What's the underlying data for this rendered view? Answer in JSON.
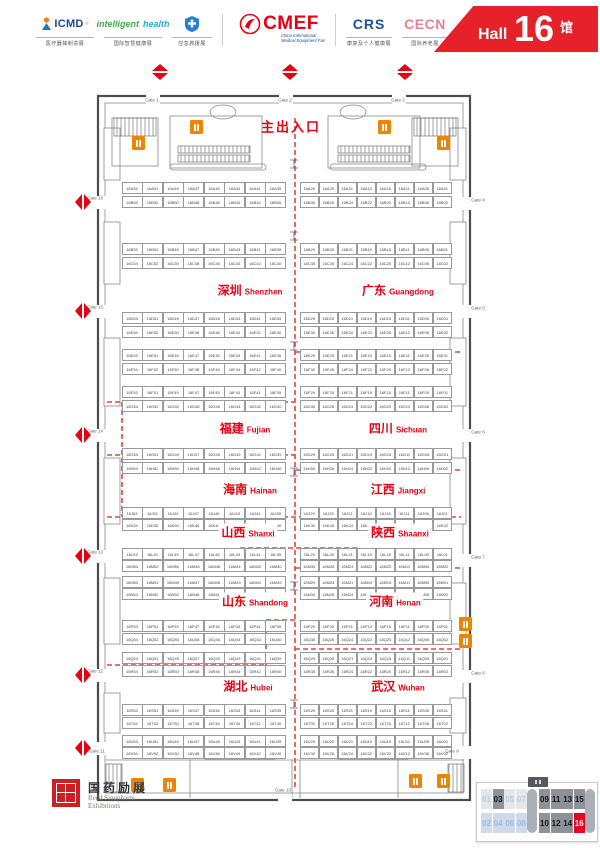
{
  "header": {
    "logos": [
      {
        "id": "icmd",
        "text": "ICMD",
        "reg": "®",
        "caption": "医疗器械制造展"
      },
      {
        "id": "intelligent-health",
        "text1": "intelligent",
        "text2": "health",
        "caption": "国际智慧健康展"
      },
      {
        "id": "emergency-rescue",
        "caption": "应急救援展"
      },
      {
        "id": "cmef",
        "text": "CMEF",
        "sub1": "China International",
        "sub2": "Medical Equipment Fair"
      },
      {
        "id": "crs",
        "text": "CRS",
        "caption": "康复及个人健康展"
      },
      {
        "id": "cecn",
        "text": "CECN",
        "caption": "国际养老展"
      },
      {
        "id": "home-healthcare",
        "caption": "家用医疗展"
      }
    ],
    "hall": {
      "word": "Hall",
      "number": "16",
      "cn": "馆"
    }
  },
  "plan": {
    "main_entrance": "主出入口",
    "gates": [
      {
        "label": "Gate 1",
        "x": 152,
        "y": 100
      },
      {
        "label": "Gate 2",
        "x": 285,
        "y": 100
      },
      {
        "label": "Gate 3",
        "x": 398,
        "y": 100
      },
      {
        "label": "Gate 4",
        "x": 478,
        "y": 200
      },
      {
        "label": "Gate 5",
        "x": 478,
        "y": 308
      },
      {
        "label": "Gate 6",
        "x": 478,
        "y": 432
      },
      {
        "label": "Gate 7",
        "x": 478,
        "y": 557
      },
      {
        "label": "Gate 8",
        "x": 478,
        "y": 673
      },
      {
        "label": "Gate 9",
        "x": 452,
        "y": 751
      },
      {
        "label": "Gate 10",
        "x": 283,
        "y": 790
      },
      {
        "label": "Gate 11",
        "x": 97,
        "y": 751
      },
      {
        "label": "Gate 12",
        "x": 95,
        "y": 671
      },
      {
        "label": "Gate 13",
        "x": 95,
        "y": 552
      },
      {
        "label": "Gate 14",
        "x": 95,
        "y": 431
      },
      {
        "label": "Gate 15",
        "x": 95,
        "y": 307
      },
      {
        "label": "Gate 16",
        "x": 95,
        "y": 198
      }
    ],
    "diamonds": [
      {
        "x": 160,
        "y": 72,
        "dir": "v"
      },
      {
        "x": 290,
        "y": 72,
        "dir": "v"
      },
      {
        "x": 405,
        "y": 72,
        "dir": "v"
      },
      {
        "x": 83,
        "y": 202,
        "dir": "h"
      },
      {
        "x": 83,
        "y": 311,
        "dir": "h"
      },
      {
        "x": 83,
        "y": 435,
        "dir": "h"
      },
      {
        "x": 83,
        "y": 556,
        "dir": "h"
      },
      {
        "x": 83,
        "y": 675,
        "dir": "h"
      },
      {
        "x": 83,
        "y": 748,
        "dir": "h"
      }
    ],
    "regions": [
      {
        "cn": "深圳",
        "en": "Shenzhen",
        "cx": 250,
        "y": 290
      },
      {
        "cn": "广东",
        "en": "Guangdong",
        "cx": 398,
        "y": 290
      },
      {
        "cn": "福建",
        "en": "Fujian",
        "cx": 245,
        "y": 428
      },
      {
        "cn": "四川",
        "en": "Sichuan",
        "cx": 398,
        "y": 428
      },
      {
        "cn": "海南",
        "en": "Hainan",
        "cx": 250,
        "y": 489
      },
      {
        "cn": "江西",
        "en": "Jiangxi",
        "cx": 398,
        "y": 489
      },
      {
        "cn": "山西",
        "en": "Shanxi",
        "cx": 248,
        "y": 532
      },
      {
        "cn": "陕西",
        "en": "Shaanxi",
        "cx": 400,
        "y": 532
      },
      {
        "cn": "山东",
        "en": "Shandong",
        "cx": 255,
        "y": 601
      },
      {
        "cn": "河南",
        "en": "Henan",
        "cx": 395,
        "y": 601
      },
      {
        "cn": "湖北",
        "en": "Hubei",
        "cx": 248,
        "y": 686
      },
      {
        "cn": "武汉",
        "en": "Wuhan",
        "cx": 398,
        "y": 686
      }
    ],
    "toilets": [
      {
        "x": 190,
        "y": 120
      },
      {
        "x": 378,
        "y": 120
      },
      {
        "x": 132,
        "y": 136
      },
      {
        "x": 437,
        "y": 136
      },
      {
        "x": 459,
        "y": 617
      },
      {
        "x": 459,
        "y": 634
      },
      {
        "x": 131,
        "y": 778
      },
      {
        "x": 163,
        "y": 778
      },
      {
        "x": 409,
        "y": 774
      },
      {
        "x": 437,
        "y": 774
      }
    ],
    "booth_rows": [
      {
        "y": 182,
        "left": [
          "16A53",
          "16A51",
          "16A49",
          "16A47",
          "16A45",
          "16A43",
          "16A41",
          "16A39"
        ],
        "right": [
          "16A29",
          "16A25",
          "16A21",
          "16A19",
          "16A15",
          "16A11",
          "16A05",
          "16A01"
        ]
      },
      {
        "y": 196,
        "left": [
          "16B54",
          "16B52",
          "16B50",
          "16B48",
          "16B46",
          "16B44",
          "16B42",
          "16B40"
        ],
        "right": [
          "16B30",
          "16B26",
          "16B24",
          "16B22",
          "16B20",
          "16B12",
          "16B06",
          "16B02"
        ]
      },
      {
        "y": 243,
        "left": [
          "16B53",
          "16B51",
          "16B49",
          "16B47",
          "16B45",
          "16B43",
          "16B41",
          "16B39"
        ],
        "right": [
          "16B29",
          "16B25",
          "16B21",
          "16B19",
          "16B15",
          "16B11",
          "16B05",
          "16B01"
        ]
      },
      {
        "y": 257,
        "left": [
          "16C54",
          "16C52",
          "16C50",
          "16C48",
          "16C46",
          "16C44",
          "16C42",
          "16C40"
        ],
        "right": [
          "16C30",
          "16C26",
          "16C24",
          "16C22",
          "16C20",
          "16C12",
          "16C06",
          "16C02"
        ]
      },
      {
        "y": 312,
        "left": [
          "16D53",
          "16D51",
          "16D49",
          "16D47",
          "16D45",
          "16D43",
          "16D41",
          "16D39"
        ],
        "right": [
          "16D29",
          "16D25",
          "16D21",
          "16D19",
          "16D15",
          "16D11",
          "16D05",
          "16D01"
        ]
      },
      {
        "y": 326,
        "left": [
          "16E54",
          "16E52",
          "16E50",
          "16E48",
          "16E46",
          "16E44",
          "16E42",
          "16E40"
        ],
        "right": [
          "16E30",
          "16E26",
          "16E24",
          "16E22",
          "16E20",
          "16E12",
          "16E06",
          "16E02"
        ]
      },
      {
        "y": 349,
        "left": [
          "16E53",
          "16E51",
          "16E49",
          "16E47",
          "16E45",
          "16E43",
          "16E41",
          "16E39"
        ],
        "right": [
          "16E29",
          "16E25",
          "16E21",
          "16E19",
          "16E15",
          "16E11",
          "16E05",
          "16E01"
        ]
      },
      {
        "y": 363,
        "left": [
          "16F54",
          "16F52",
          "16F50",
          "16F48",
          "16F46",
          "16F44",
          "16F42",
          "16F40"
        ],
        "right": [
          "16F30",
          "16F26",
          "16F24",
          "16F22",
          "16F20",
          "16F12",
          "16F06",
          "16F02"
        ]
      },
      {
        "y": 386,
        "left": [
          "16F53",
          "16F51",
          "16F49",
          "16F47",
          "16F45",
          "16F43",
          "16F41",
          "16F39"
        ],
        "right": [
          "16F29",
          "16F25",
          "16F21",
          "16F19",
          "16F15",
          "16F11",
          "16F05",
          "16F01"
        ]
      },
      {
        "y": 400,
        "left": [
          "16G54",
          "16G52",
          "16G50",
          "16G48",
          "16G46",
          "16G44",
          "16G42",
          "16G40"
        ],
        "right": [
          "16G30",
          "16G26",
          "16G24",
          "16G22",
          "16G20",
          "16G12",
          "16G06",
          "16G02"
        ]
      },
      {
        "y": 448,
        "left": [
          "16G53",
          "16G51",
          "16G49",
          "16G47",
          "16G45",
          "16G43",
          "16G41",
          "16G39"
        ],
        "right": [
          "16G29",
          "16G25",
          "16G21",
          "16G19",
          "16G15",
          "16G11",
          "16G05",
          "16G01"
        ]
      },
      {
        "y": 462,
        "left": [
          "16H54",
          "16H52",
          "16H50",
          "16H48",
          "16H46",
          "16H44",
          "16H42",
          "16H40"
        ],
        "right": [
          "16H30",
          "16H26",
          "16H24",
          "16H22",
          "16H20",
          "16H12",
          "16H06",
          "16H02"
        ]
      },
      {
        "y": 507,
        "left": [
          "16J53",
          "16J51",
          "16J49",
          "16J47",
          "16J45",
          "16J43",
          "16J41",
          "16J39"
        ],
        "right": [
          "16J29",
          "16J25",
          "16J21",
          "16J19",
          "16J15",
          "16J11",
          "16J05",
          "16J01"
        ]
      },
      {
        "y": 519,
        "left": [
          "16K54",
          "16K52",
          "16K50",
          "16K48",
          "16K46",
          "16K44",
          "16K42",
          "16K40"
        ],
        "right": [
          "16K30",
          "16K26",
          "16K24",
          "16K22",
          "16K20",
          "16K12",
          "16K06",
          "16K02"
        ]
      },
      {
        "y": 548,
        "left": [
          "16L53",
          "16L51",
          "16L49",
          "16L47",
          "16L45",
          "16L43",
          "16L41",
          "16L39"
        ],
        "right": [
          "16L29",
          "16L25",
          "16L21",
          "16L19",
          "16L15",
          "16L11",
          "16L05",
          "16L01"
        ]
      },
      {
        "y": 560,
        "left": [
          "16M54",
          "16M52",
          "16M50",
          "16M48",
          "16M46",
          "16M44",
          "16M42",
          "16M40"
        ],
        "right": [
          "16M30",
          "16M26",
          "16M24",
          "16M22",
          "16M20",
          "16M12",
          "16M06",
          "16M02"
        ]
      },
      {
        "y": 576,
        "left": [
          "16M53",
          "16M51",
          "16M49",
          "16M47",
          "16M45",
          "16M43",
          "16M41",
          "16M39"
        ],
        "right": [
          "16M29",
          "16M25",
          "16M21",
          "16M19",
          "16M15",
          "16M11",
          "16M05",
          "16M01"
        ]
      },
      {
        "y": 588,
        "left": [
          "16N54",
          "16N52",
          "16N50",
          "16N48",
          "16N46",
          "16N44",
          "16N42",
          "16N40"
        ],
        "right": [
          "16N30",
          "16N26",
          "16N24",
          "16N22",
          "16N20",
          "16N12",
          "16N06",
          "16N02"
        ]
      },
      {
        "y": 620,
        "left": [
          "16P53",
          "16P51",
          "16P49",
          "16P47",
          "16P45",
          "16P43",
          "16P41",
          "16P39"
        ],
        "right": [
          "16P29",
          "16P25",
          "16P21",
          "16P19",
          "16P15",
          "16P11",
          "16P05",
          "16P01"
        ]
      },
      {
        "y": 633,
        "left": [
          "16Q54",
          "16Q52",
          "16Q50",
          "16Q48",
          "16Q46",
          "16Q44",
          "16Q42",
          "16Q40"
        ],
        "right": [
          "16Q30",
          "16Q26",
          "16Q24",
          "16Q22",
          "16Q20",
          "16Q12",
          "16Q06",
          "16Q02"
        ]
      },
      {
        "y": 652,
        "left": [
          "16Q53",
          "16Q51",
          "16Q49",
          "16Q47",
          "16Q45",
          "16Q43",
          "16Q41",
          "16Q39"
        ],
        "right": [
          "16Q29",
          "16Q25",
          "16Q21",
          "16Q19",
          "16Q15",
          "16Q11",
          "16Q05",
          "16Q01"
        ]
      },
      {
        "y": 665,
        "left": [
          "16R54",
          "16R52",
          "16R50",
          "16R48",
          "16R46",
          "16R44",
          "16R42",
          "16R40"
        ],
        "right": [
          "16R30",
          "16R26",
          "16R24",
          "16R22",
          "16R20",
          "16R12",
          "16R06",
          "16R02"
        ]
      },
      {
        "y": 704,
        "left": [
          "16S53",
          "16S51",
          "16S49",
          "16S47",
          "16S45",
          "16S43",
          "16S41",
          "16S39"
        ],
        "right": [
          "16S29",
          "16S25",
          "16S21",
          "16S19",
          "16S15",
          "16S11",
          "16S05",
          "16S01"
        ]
      },
      {
        "y": 717,
        "left": [
          "16T54",
          "16T52",
          "16T50",
          "16T48",
          "16T46",
          "16T44",
          "16T42",
          "16T40"
        ],
        "right": [
          "16T30",
          "16T26",
          "16T24",
          "16T22",
          "16T20",
          "16T12",
          "16T06",
          "16T02"
        ]
      },
      {
        "y": 735,
        "left": [
          "16U53",
          "16U51",
          "16U49",
          "16U47",
          "16U45",
          "16U43",
          "16U41",
          "16U39"
        ],
        "right": [
          "16U29",
          "16U25",
          "16U21",
          "16U19",
          "16U15",
          "16U11",
          "16U05",
          "16U01"
        ]
      },
      {
        "y": 747,
        "left": [
          "16V54",
          "16V52",
          "16V50",
          "16V48",
          "16V46",
          "16V44",
          "16V42",
          "16V40"
        ],
        "right": [
          "16V30",
          "16V26",
          "16V24",
          "16V22",
          "16V20",
          "16V12",
          "16V06",
          "16V02"
        ]
      }
    ]
  },
  "footer": {
    "logo_cn": "国药励展",
    "logo_en1": "Reed Sinopharm",
    "logo_en2": "Exhibitions"
  },
  "legend": {
    "row1": [
      {
        "t": "01",
        "s": "light"
      },
      {
        "t": "03",
        "s": "dark"
      },
      {
        "t": "05",
        "s": "light"
      },
      {
        "t": "07",
        "s": "light"
      },
      {
        "t": "09",
        "s": "dark"
      },
      {
        "t": "11",
        "s": "dark"
      },
      {
        "t": "13",
        "s": "dark"
      },
      {
        "t": "15",
        "s": "dark"
      }
    ],
    "row2": [
      {
        "t": "02",
        "s": "blue"
      },
      {
        "t": "04",
        "s": "blue"
      },
      {
        "t": "06",
        "s": "blue"
      },
      {
        "t": "08",
        "s": "blue"
      },
      {
        "t": "10",
        "s": "dark"
      },
      {
        "t": "12",
        "s": "dark"
      },
      {
        "t": "14",
        "s": "dark"
      },
      {
        "t": "16",
        "s": "active"
      }
    ]
  }
}
